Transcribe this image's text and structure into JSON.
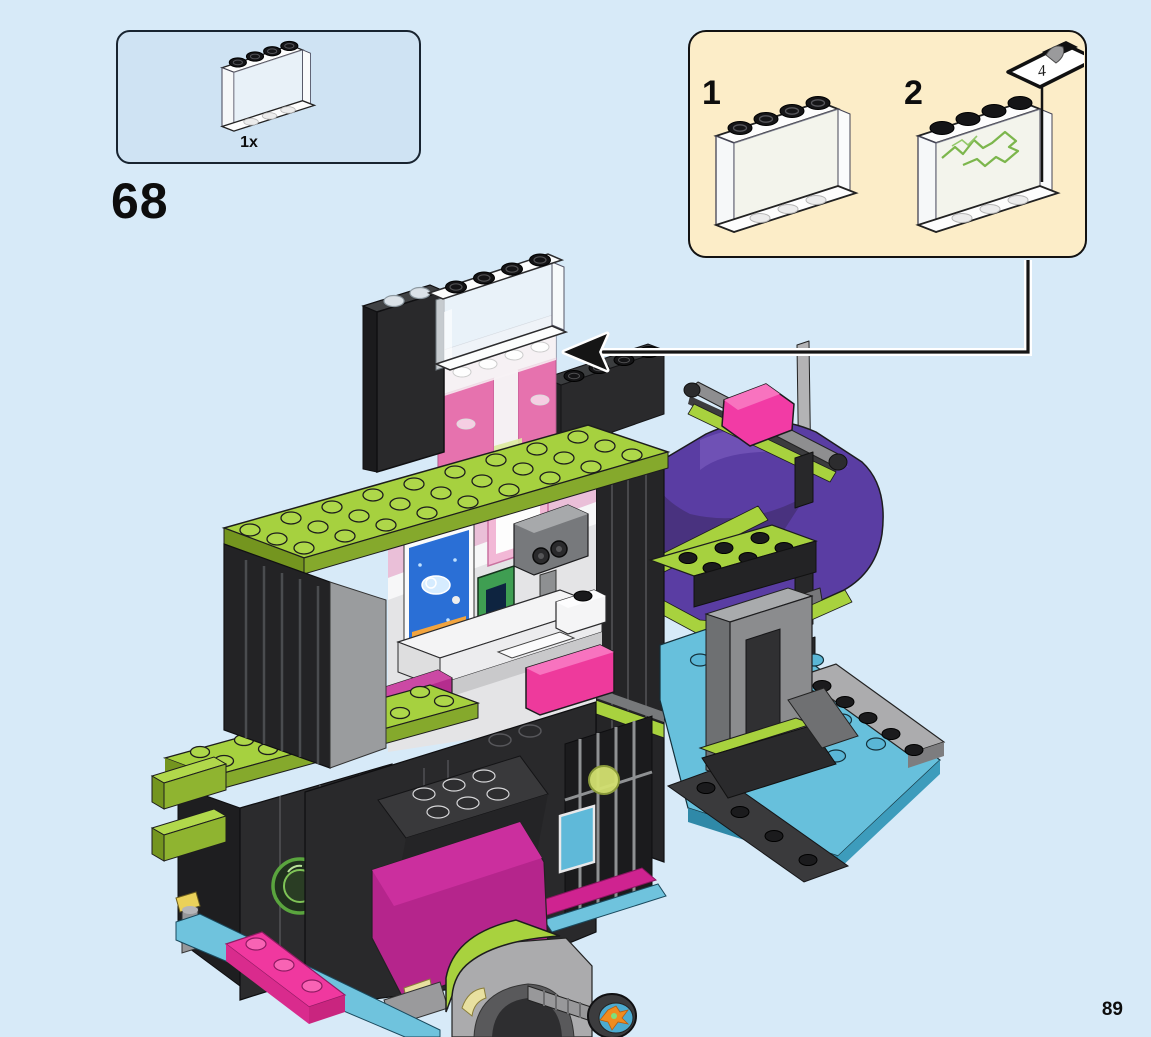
{
  "page": {
    "number": "89",
    "background_color": "#d7eaf8"
  },
  "step": {
    "number": "68"
  },
  "parts_box": {
    "count_label": "1x",
    "part_name": "trans-clear-panel-1x4x3-with-black-studs",
    "background_color": "#cfe3f3"
  },
  "callout": {
    "background_color": "#fcedc8",
    "step_1_label": "1",
    "step_2_label": "2",
    "sticker_number": "4",
    "step_1_content": "place trans-clear panel",
    "step_2_content": "apply sticker 4 (green lightning) to panel"
  },
  "model": {
    "description": "LEGO lair build: black tower with lime studded plates, trans-clear panel with black studs being added on top (arrow), interior with blue poster, camera and pink furniture, purple slide with pink flag at right, azure baseplate, magenta ramp, gray arch with roller wheel at bottom",
    "colors": {
      "black_brick": "#262628",
      "lime": "#a6d13f",
      "magenta": "#b5258c",
      "bright_pink": "#ee3a9c",
      "purple": "#5a3da3",
      "azure_plate": "#67c0dc",
      "gray": "#97999b",
      "poster_blue": "#2a6fd6",
      "sticker_scribble_green": "#7cb64c"
    }
  }
}
